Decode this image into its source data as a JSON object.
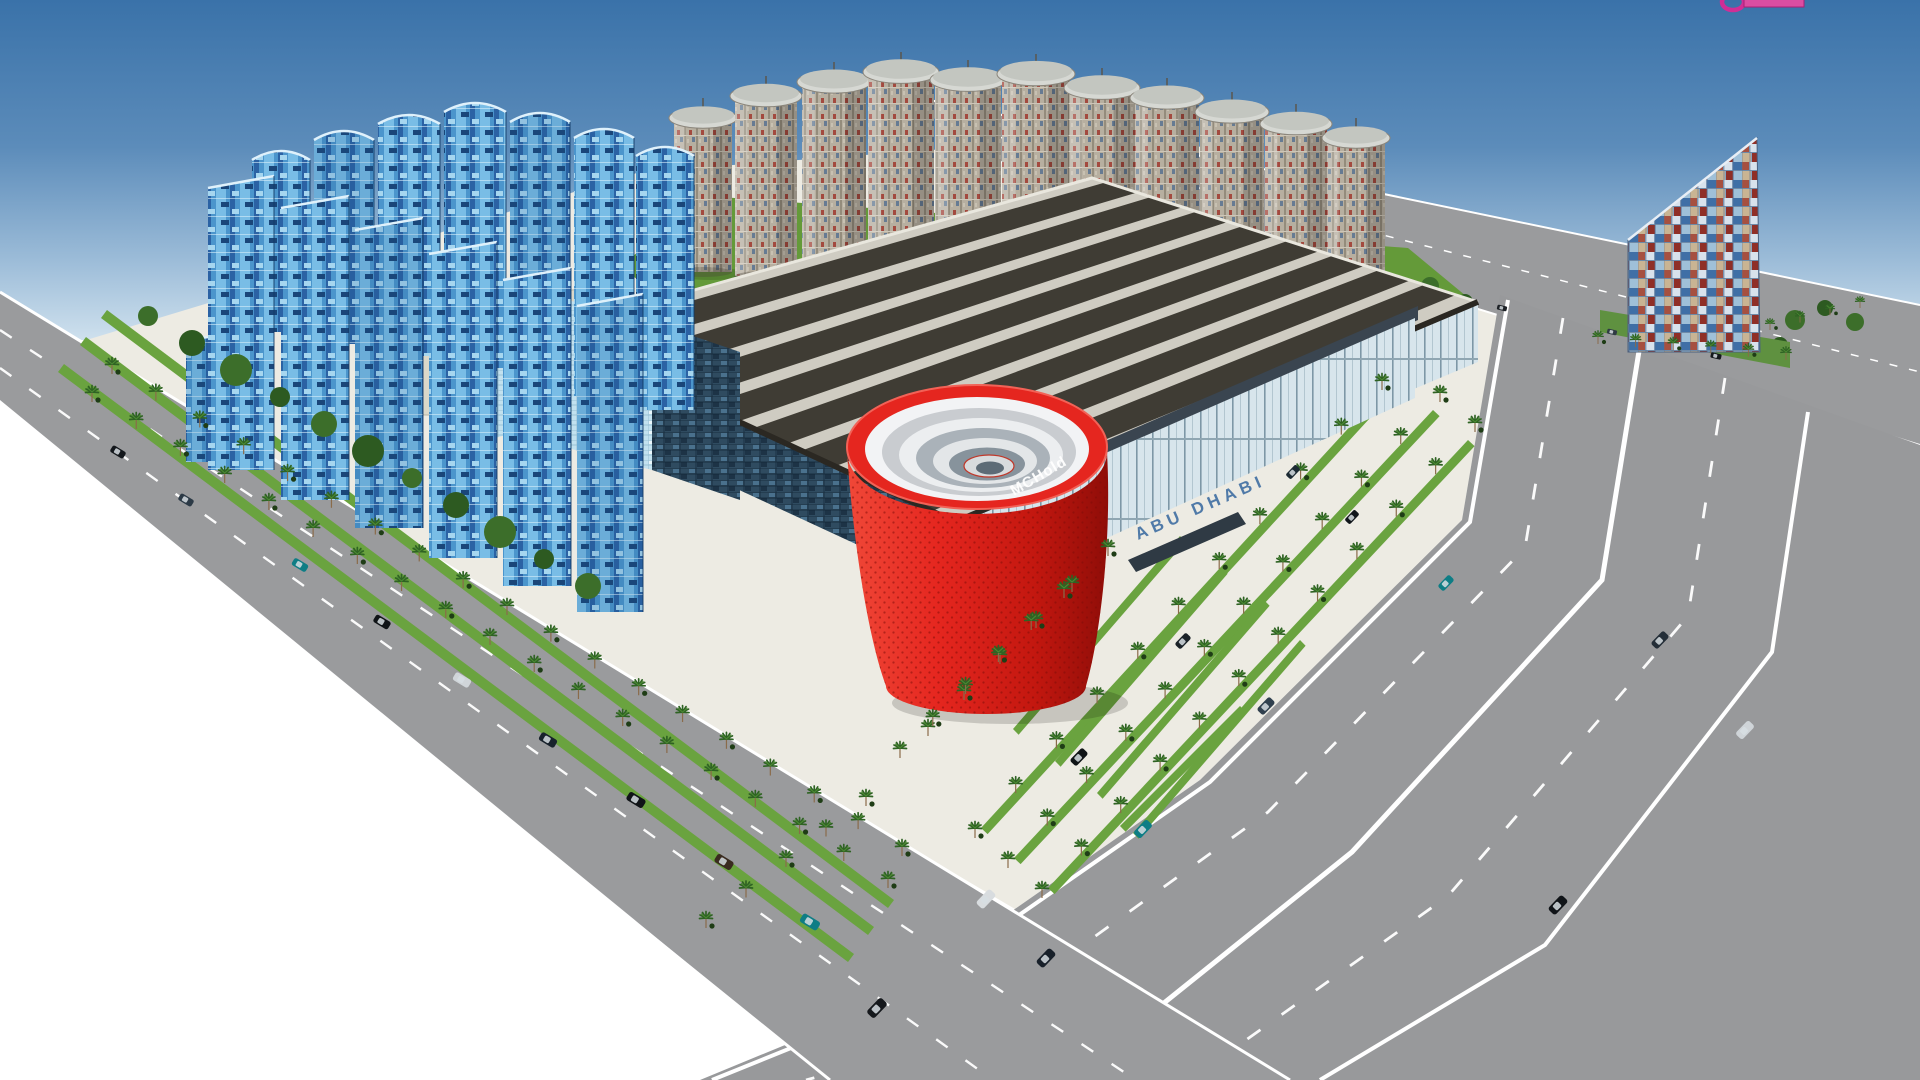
{
  "scene": {
    "type": "3d-architectural-rendering",
    "description": "Aerial 3D rendering of an exhibition-centre complex: blue glass slab towers, a back row of cylindrical towers, a large hall with striped roof, a red conical drum landmark, a mosaic sail tower, palm-lined boulevards and highways with traffic.",
    "labels": {
      "red_drum_text": "MCHold",
      "entrance_glass_text": "ABU DHABI"
    },
    "colors": {
      "sky_top": "#3a72a9",
      "sky_mid": "#9cbcd8",
      "sky_horizon": "#ffffff",
      "road": "#9a9b9d",
      "road_marking": "#ffffff",
      "site": "#edebe3",
      "grass": "#6aa33f",
      "lawn": "#649a39",
      "tree": "#2d5a21",
      "palm": "#2f6323",
      "glass_blue": "#4b95cc",
      "roof_dark": "#3f3c34",
      "roof_light": "#cfccc2",
      "drum_red": "#e2231a",
      "drum_red_dark": "#8f0d08",
      "entrance_text_blue": "#35679e",
      "watermark_pink": "#d8439f"
    }
  }
}
